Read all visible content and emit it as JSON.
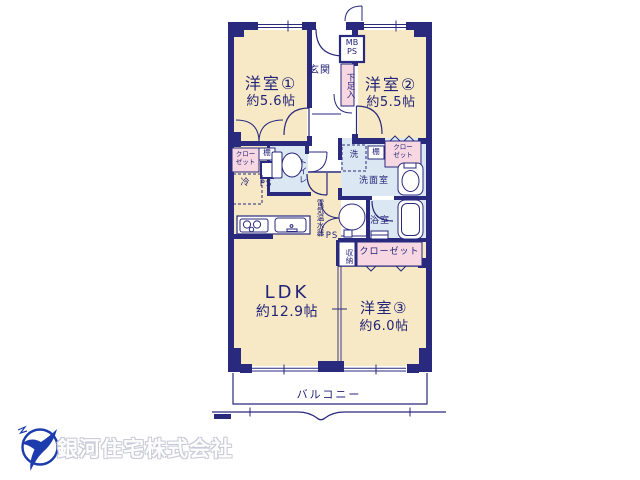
{
  "company": {
    "name": "銀河住宅株式会社"
  },
  "colors": {
    "wall_navy": "#29297d",
    "label_navy": "#232378",
    "room_cream": "#f7e9c6",
    "wet_blue": "#dbe7f3",
    "closet_pink": "#f7d8e2",
    "logo_blue": "#1c3cae",
    "company_gray": "#c9cad6"
  },
  "plan": {
    "rooms": {
      "room1": {
        "name": "洋室①",
        "size": "約5.6帖"
      },
      "room2": {
        "name": "洋室②",
        "size": "約5.5帖"
      },
      "room3": {
        "name": "洋室③",
        "size": "約6.0帖"
      },
      "ldk": {
        "name": "LDK",
        "size": "約12.9帖"
      },
      "balcony": {
        "name": "バルコニー"
      },
      "entrance": {
        "name": "玄関"
      },
      "washroom": {
        "name": "洗面室"
      },
      "bathroom": {
        "name": "浴室"
      }
    },
    "labels": {
      "toilet": "トイレ",
      "shoe_box": "下足入",
      "mb": "MB",
      "ps": "PS",
      "closet_line1": "クロー",
      "closet_line2": "ゼット",
      "closet": "クローゼット",
      "shelf": "棚",
      "fridge": "冷",
      "washer": "洗",
      "water_heater": "電気温水器",
      "storage": "収納"
    }
  }
}
